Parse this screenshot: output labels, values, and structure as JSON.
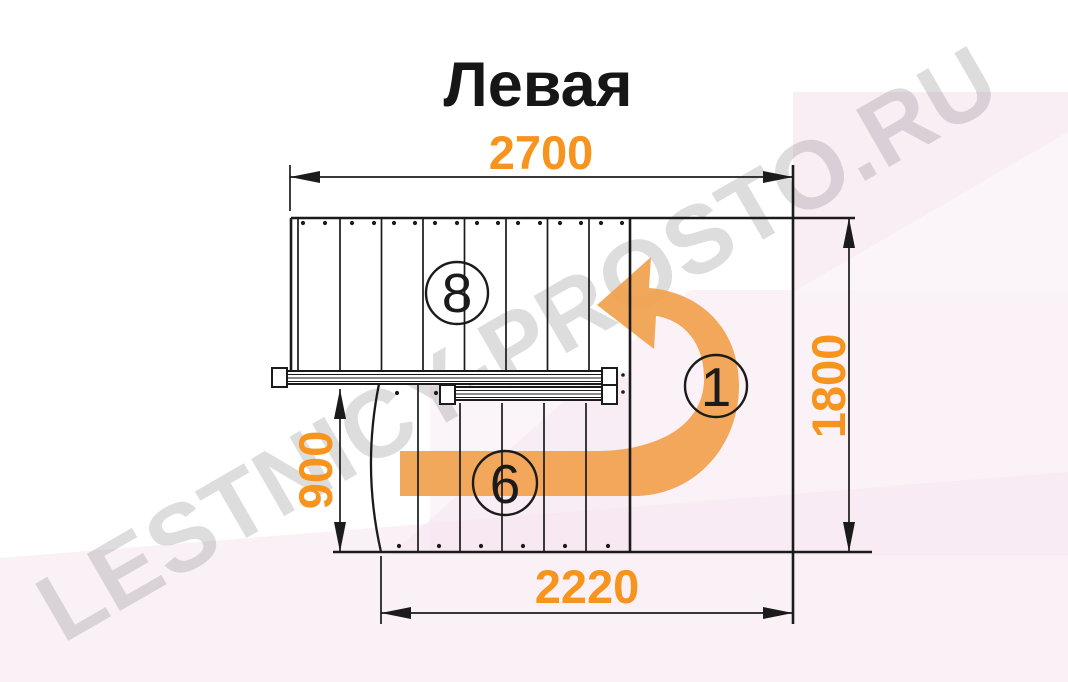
{
  "title": "Левая",
  "watermark": "LESTNICY-PROSTO.RU",
  "dimensions": {
    "top_width": "2700",
    "right_height": "1800",
    "left_inner_height": "900",
    "bottom_width": "2220"
  },
  "step_labels": {
    "upper_flight_steps": "8",
    "lower_flight_steps": "6",
    "start_step": "1"
  },
  "colors": {
    "dimension_text": "#F7941D",
    "direction_arrow": "#F1A14E",
    "linework": "#1b1b1b",
    "watermark_gray": "#9B9BA0",
    "background_pink": "#F6E3EF",
    "title_text": "#161616"
  }
}
